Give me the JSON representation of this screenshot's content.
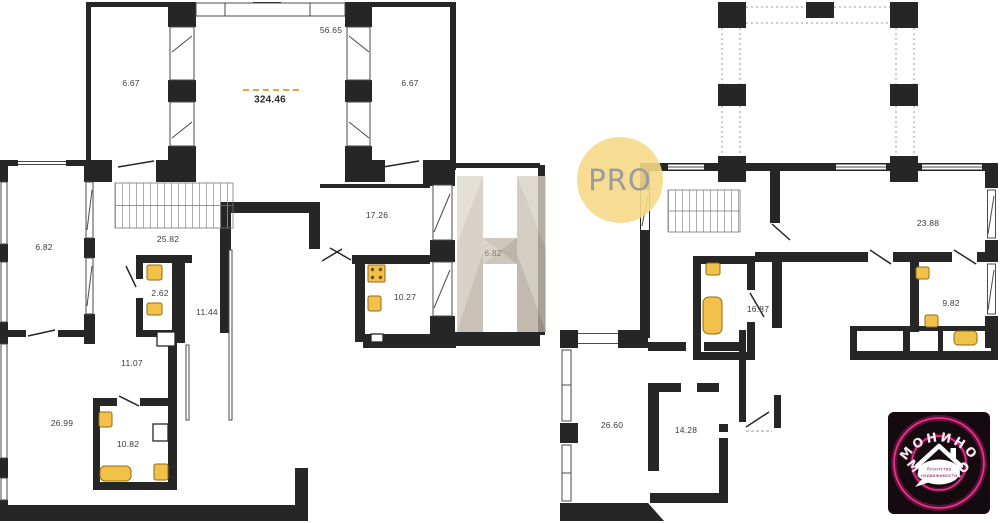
{
  "plans": {
    "left": {
      "total_area": "324.46",
      "rooms": [
        {
          "id": "balcony-left",
          "area": "6.67"
        },
        {
          "id": "hall-top",
          "area": "56.65"
        },
        {
          "id": "balcony-right",
          "area": "6.67"
        },
        {
          "id": "room-682-left",
          "area": "6.82"
        },
        {
          "id": "stairs",
          "area": "25.82"
        },
        {
          "id": "wc",
          "area": "2.62"
        },
        {
          "id": "corridor",
          "area": "11.44"
        },
        {
          "id": "room-1726",
          "area": "17.26"
        },
        {
          "id": "kitchen",
          "area": "10.27"
        },
        {
          "id": "room-682-right",
          "area": "6.82"
        },
        {
          "id": "room-1107",
          "area": "11.07"
        },
        {
          "id": "room-2699",
          "area": "26.99"
        },
        {
          "id": "bathroom",
          "area": "10.82"
        }
      ]
    },
    "right": {
      "rooms": [
        {
          "id": "room-2388",
          "area": "23.88"
        },
        {
          "id": "room-982",
          "area": "9.82"
        },
        {
          "id": "room-1687",
          "area": "16.87"
        },
        {
          "id": "room-2660",
          "area": "26.60"
        },
        {
          "id": "room-1428",
          "area": "14.28"
        }
      ]
    }
  },
  "watermarks": {
    "pro": {
      "label": "PRO",
      "circle_color": "#F5D78C",
      "text_color": "#9B9B9B"
    },
    "h": {
      "color": "#CCC5B9"
    }
  },
  "logo": {
    "name_top": "МОНИНО",
    "name_bottom": "МОНИНО",
    "tagline_line1": "Агентство",
    "tagline_line2": "недвижимости",
    "accent_color": "#FF2E96",
    "background_color": "#150A10"
  },
  "colors": {
    "wall": "#262626",
    "fixture": "#F1C14A",
    "fixture_border": "#8F6A12",
    "area_note": "#E8A33D",
    "label": "#3A3A3A"
  }
}
